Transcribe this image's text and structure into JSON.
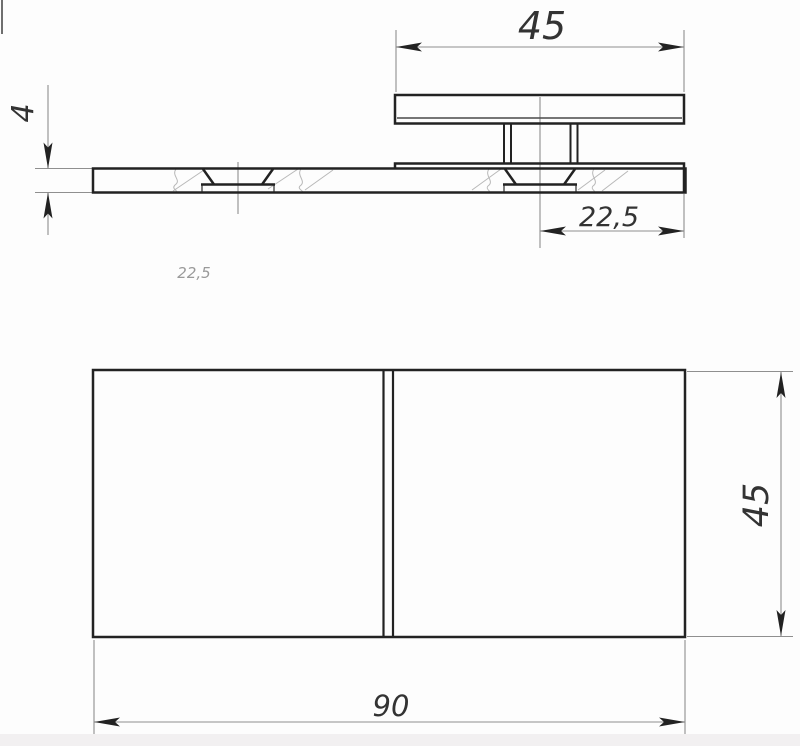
{
  "drawing": {
    "dimensions": {
      "top_plate_width": "45",
      "base_thickness": "4",
      "hole_offset": "22,5",
      "hole_offset_faded": "22,5",
      "base_width": "45",
      "base_length": "90"
    },
    "colors": {
      "background": "#fdfdfd",
      "line_dark": "#222222",
      "line_medium": "#4a4a4a",
      "line_thin": "#8f8f8f",
      "texture": "#b8b8b8",
      "text": "#333333",
      "text_faded": "#9a9a9a",
      "artifact": "#6f6f6f",
      "bottom_band": "#f2f0f1"
    }
  }
}
